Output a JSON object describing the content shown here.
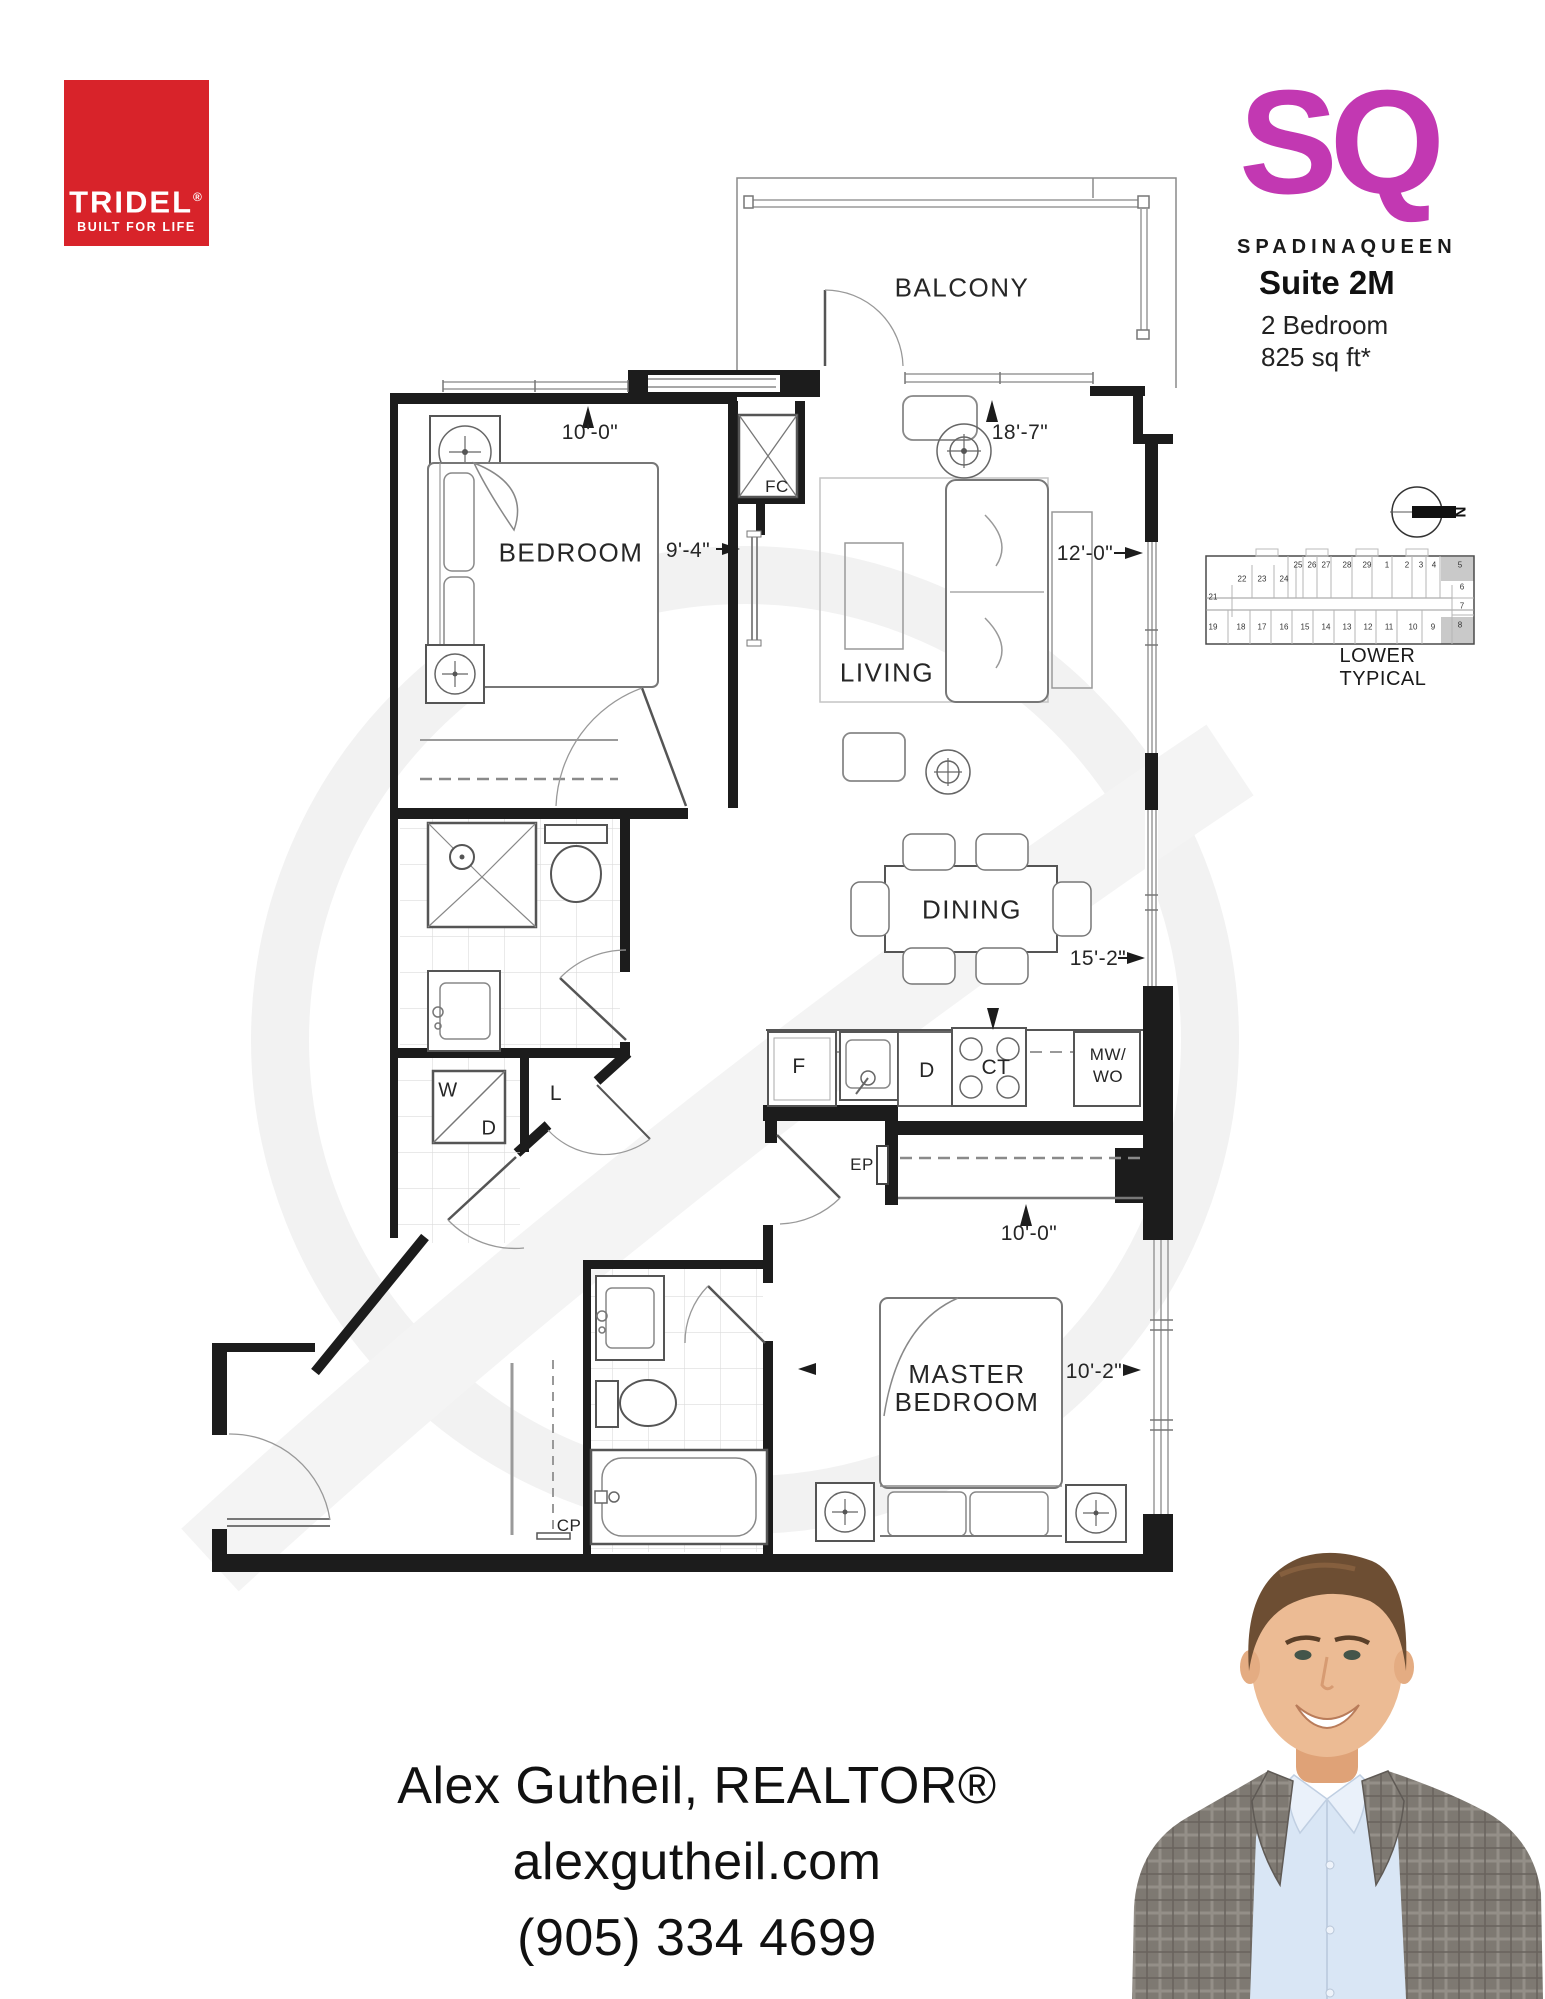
{
  "branding": {
    "tridel_name": "TRIDEL",
    "tridel_reg": "®",
    "tridel_tagline": "BUILT FOR LIFE",
    "tridel_red": "#d8232a"
  },
  "project": {
    "logo": "SQ",
    "location_left": "SPADINA",
    "location_right": "QUEEN",
    "suite_label": "Suite 2M",
    "suite_type": "2 Bedroom",
    "suite_area": "825  sq ft*",
    "magenta": "#c238b2",
    "arrow_gold": "#edc41d"
  },
  "keyplan": {
    "caption": "LOWER TYPICAL",
    "north_label": "N",
    "top_row": [
      "25",
      "26",
      "27",
      "28",
      "29",
      "1",
      "2",
      "3",
      "4",
      "5"
    ],
    "second_row": [
      "22",
      "23",
      "24"
    ],
    "left_unit": "21",
    "right_column": [
      "6",
      "7",
      "8"
    ],
    "bottom_row": [
      "19",
      "18",
      "17",
      "16",
      "15",
      "14",
      "13",
      "12",
      "11",
      "10",
      "9"
    ],
    "highlighted_units": [
      "5",
      "8"
    ],
    "highlight_color": "#c9c9c9"
  },
  "plan": {
    "rooms": {
      "balcony": "BALCONY",
      "bedroom": "BEDROOM",
      "living": "LIVING",
      "dining": "DINING",
      "master_line1": "MASTER",
      "master_line2": "BEDROOM"
    },
    "dims": {
      "bedroom_width": "10'-0\"",
      "bedroom_depth": "9'-4\"",
      "living_length": "18'-7\"",
      "living_width": "12'-0\"",
      "dining_length": "15'-2\"",
      "master_closet_width": "10'-0\"",
      "master_width": "10'-2\""
    },
    "fixtures": {
      "foyer_closet": "FC",
      "electrical_panel": "EP",
      "coat_pantry": "CP",
      "washer": "W",
      "dryer": "D",
      "linen": "L",
      "fridge": "F",
      "dishwasher": "D",
      "cooktop": "CT",
      "microwave_line1": "MW/",
      "microwave_line2": "WO"
    }
  },
  "agent": {
    "name": "Alex Gutheil, REALTOR®",
    "website": "alexgutheil.com",
    "phone": "(905) 334 4699"
  }
}
